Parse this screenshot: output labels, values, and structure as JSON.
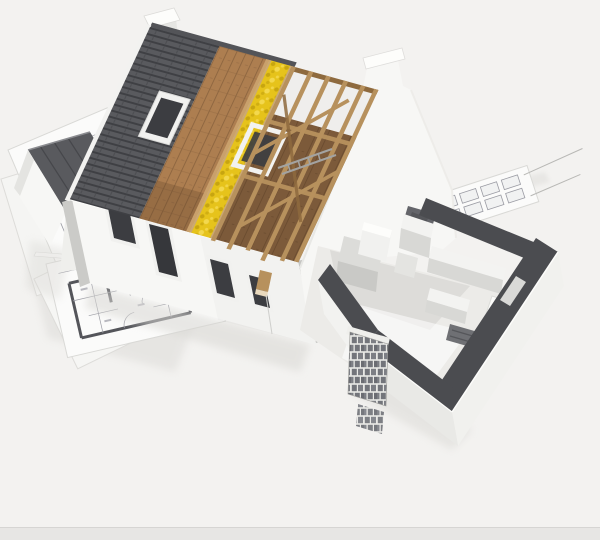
{
  "scene": {
    "subject": "3d-house-cutaway-model-on-blueprints",
    "parts": [
      "blueprint-sheets",
      "floor-plan-drawing",
      "house-left-wing",
      "front-wall-with-windows",
      "chimney",
      "stepped-gable-wall",
      "roof-shingle-layer",
      "roof-sheathing-layer",
      "roof-insulation-layer",
      "roof-truss-frame",
      "skylight-window",
      "second-floor-deck",
      "ground-floor-cutaway",
      "cut-wall-tops",
      "kitchen-units",
      "partition-walls",
      "brick-pillar"
    ]
  },
  "colors": {
    "background": "#f3f2f0",
    "border_strip": "#e7e6e4",
    "border_line": "#d6d5d3",
    "paper": "#fbfbfa",
    "paper2": "#f5f5f3",
    "paper_edge": "#d9d9d6",
    "plan_line": "#9a9ba3",
    "plan_wall": "#54555a",
    "shingle": "#595a5e",
    "shingle_dark": "#3f4044",
    "ridge": "#535458",
    "sheathing": "#ad7e50",
    "plank_line": "#7c5837",
    "insulation": "#e6c31b",
    "insulation_dark": "#c2a00e",
    "insulation_light": "#f3d84e",
    "rafter": "#b7915d",
    "rafter_dark": "#8e6a3e",
    "deck": "#7c5a3a",
    "deck_streak": "#5a3f26",
    "wall": "#f7f7f5",
    "wall_bright": "#fdfdfb",
    "wall_shade": "#e2e2df",
    "wall_side": "#cbcbc8",
    "window": "#3c3d41",
    "frame": "#f1f1ef",
    "cut_top": "#4b4c50",
    "interior_floor": "#ecebe8",
    "counter": "#dcdcd9",
    "counter_face": "#c9c9c6",
    "partition": "#f3f3f1",
    "partition_face": "#d8d8d5",
    "dark_room": "#64656a",
    "brick": "#73757b",
    "mortar": "#e8e8e5",
    "shadow": "#d9d8d4",
    "metal": "#a3a3a1"
  }
}
